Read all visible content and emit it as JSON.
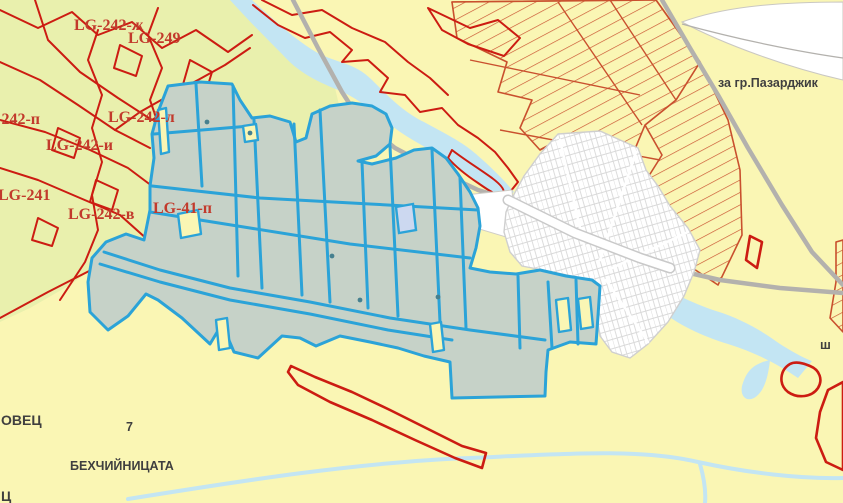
{
  "app": {
    "type": "cadastral-map-view",
    "description": "GIS cadastral map viewport"
  },
  "labels": {
    "lg_242_zh": "LG-242-ж",
    "lg_249": "LG-249",
    "lg_242_p": "LG-242-п",
    "lg_242_l": "LG-242-л",
    "lg_242_i": "LG-242-и",
    "lg_241": "LG-241",
    "lg_242_v": "LG-242-в",
    "lg_41_p": "LG-41-п",
    "to_pazardzhik": "за гр.Пазарджик",
    "ovec": "ОВЕЦ",
    "parcel_7": "7",
    "bekhchiynitsata": "БЕХЧИЙНИЦАТА",
    "ts": "Ц",
    "sh": "ш"
  },
  "colors": {
    "bg_yellow": "#faf6b4",
    "bg_green": "#e9f0ad",
    "parcel_fill": "#c6d2c8",
    "parcel_stroke": "#2ba3d8",
    "boundary_red": "#cc1c12",
    "hatch_red": "#c9502e",
    "water": "#c3e5f3",
    "road_gray": "#b3b1ad",
    "village_street": "#cfcfcf",
    "label_red": "#c23a2c",
    "label_dark": "#3f3f3f"
  }
}
